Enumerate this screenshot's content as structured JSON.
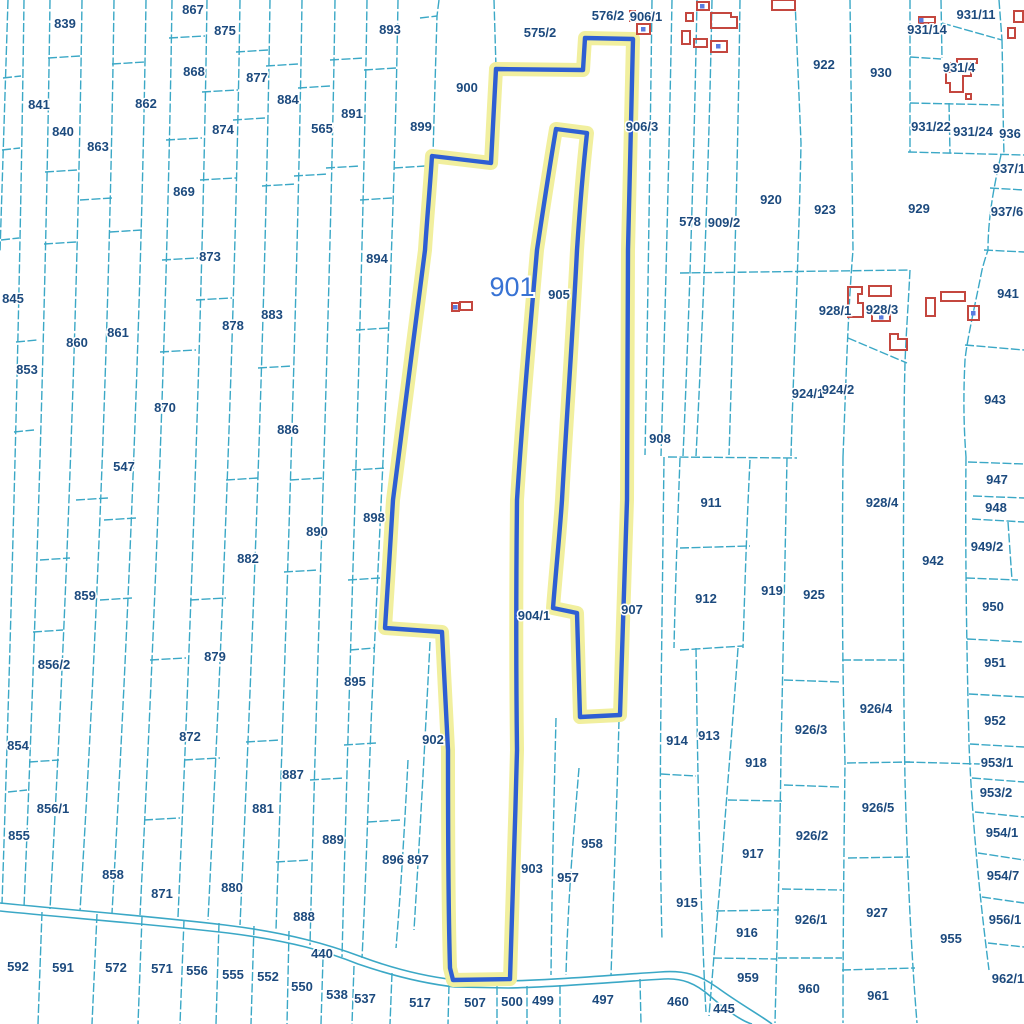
{
  "map": {
    "selected_parcel_id": "901",
    "colors": {
      "background": "#ffffff",
      "parcel_boundary": "#3ba8c6",
      "parcel_label": "#1c4a7e",
      "selected_outline": "#2e5fd3",
      "selected_halo": "#f1ef9e",
      "selected_label": "#3873d4",
      "building_outline": "#c4473f",
      "building_dot": "#5a7ce0"
    },
    "labels": [
      {
        "id": "839",
        "x": 65,
        "y": 23
      },
      {
        "id": "841",
        "x": 39,
        "y": 104
      },
      {
        "id": "840",
        "x": 63,
        "y": 131
      },
      {
        "id": "862",
        "x": 146,
        "y": 103
      },
      {
        "id": "863",
        "x": 98,
        "y": 146
      },
      {
        "id": "867",
        "x": 193,
        "y": 9
      },
      {
        "id": "875",
        "x": 225,
        "y": 30
      },
      {
        "id": "868",
        "x": 194,
        "y": 71
      },
      {
        "id": "877",
        "x": 257,
        "y": 77
      },
      {
        "id": "874",
        "x": 223,
        "y": 129
      },
      {
        "id": "884",
        "x": 288,
        "y": 99
      },
      {
        "id": "565",
        "x": 322,
        "y": 128
      },
      {
        "id": "891",
        "x": 352,
        "y": 113
      },
      {
        "id": "869",
        "x": 184,
        "y": 191
      },
      {
        "id": "893",
        "x": 390,
        "y": 29
      },
      {
        "id": "899",
        "x": 421,
        "y": 126
      },
      {
        "id": "900",
        "x": 467,
        "y": 87
      },
      {
        "id": "575/2",
        "x": 540,
        "y": 32
      },
      {
        "id": "576/2",
        "x": 608,
        "y": 15
      },
      {
        "id": "906/1",
        "x": 646,
        "y": 16
      },
      {
        "id": "906/3",
        "x": 642,
        "y": 126
      },
      {
        "id": "578",
        "x": 690,
        "y": 221
      },
      {
        "id": "909/2",
        "x": 724,
        "y": 222
      },
      {
        "id": "920",
        "x": 771,
        "y": 199
      },
      {
        "id": "922",
        "x": 824,
        "y": 64
      },
      {
        "id": "923",
        "x": 825,
        "y": 209
      },
      {
        "id": "930",
        "x": 881,
        "y": 72
      },
      {
        "id": "929",
        "x": 919,
        "y": 208
      },
      {
        "id": "931/11",
        "x": 976,
        "y": 14
      },
      {
        "id": "931/14",
        "x": 927,
        "y": 29
      },
      {
        "id": "931/4",
        "x": 959,
        "y": 67
      },
      {
        "id": "931/22",
        "x": 931,
        "y": 126
      },
      {
        "id": "931/24",
        "x": 973,
        "y": 131
      },
      {
        "id": "936",
        "x": 1010,
        "y": 133
      },
      {
        "id": "937/1",
        "x": 1009,
        "y": 168
      },
      {
        "id": "937/6",
        "x": 1007,
        "y": 211
      },
      {
        "id": "941",
        "x": 1008,
        "y": 293
      },
      {
        "id": "845",
        "x": 13,
        "y": 298
      },
      {
        "id": "853",
        "x": 27,
        "y": 369
      },
      {
        "id": "860",
        "x": 77,
        "y": 342
      },
      {
        "id": "861",
        "x": 118,
        "y": 332
      },
      {
        "id": "870",
        "x": 165,
        "y": 407
      },
      {
        "id": "873",
        "x": 210,
        "y": 256
      },
      {
        "id": "878",
        "x": 233,
        "y": 325
      },
      {
        "id": "883",
        "x": 272,
        "y": 314
      },
      {
        "id": "886",
        "x": 288,
        "y": 429
      },
      {
        "id": "894",
        "x": 377,
        "y": 258
      },
      {
        "id": "901",
        "x": 512,
        "y": 287,
        "big": true
      },
      {
        "id": "905",
        "x": 559,
        "y": 294
      },
      {
        "id": "908",
        "x": 660,
        "y": 438
      },
      {
        "id": "928/1",
        "x": 835,
        "y": 310
      },
      {
        "id": "928/3",
        "x": 882,
        "y": 309
      },
      {
        "id": "924/1",
        "x": 808,
        "y": 393
      },
      {
        "id": "924/2",
        "x": 838,
        "y": 389
      },
      {
        "id": "943",
        "x": 995,
        "y": 399
      },
      {
        "id": "947",
        "x": 997,
        "y": 479
      },
      {
        "id": "547",
        "x": 124,
        "y": 466
      },
      {
        "id": "890",
        "x": 317,
        "y": 531
      },
      {
        "id": "898",
        "x": 374,
        "y": 517
      },
      {
        "id": "882",
        "x": 248,
        "y": 558
      },
      {
        "id": "859",
        "x": 85,
        "y": 595
      },
      {
        "id": "856/2",
        "x": 54,
        "y": 664
      },
      {
        "id": "854",
        "x": 18,
        "y": 745
      },
      {
        "id": "879",
        "x": 215,
        "y": 656
      },
      {
        "id": "895",
        "x": 355,
        "y": 681
      },
      {
        "id": "872",
        "x": 190,
        "y": 736
      },
      {
        "id": "902",
        "x": 433,
        "y": 739
      },
      {
        "id": "904/1",
        "x": 534,
        "y": 615
      },
      {
        "id": "907",
        "x": 632,
        "y": 609
      },
      {
        "id": "911",
        "x": 711,
        "y": 502
      },
      {
        "id": "912",
        "x": 706,
        "y": 598
      },
      {
        "id": "919",
        "x": 772,
        "y": 590
      },
      {
        "id": "925",
        "x": 814,
        "y": 594
      },
      {
        "id": "928/4",
        "x": 882,
        "y": 502
      },
      {
        "id": "942",
        "x": 933,
        "y": 560
      },
      {
        "id": "948",
        "x": 996,
        "y": 507
      },
      {
        "id": "949/2",
        "x": 987,
        "y": 546
      },
      {
        "id": "950",
        "x": 993,
        "y": 606
      },
      {
        "id": "951",
        "x": 995,
        "y": 662
      },
      {
        "id": "926/4",
        "x": 876,
        "y": 708
      },
      {
        "id": "926/3",
        "x": 811,
        "y": 729
      },
      {
        "id": "913",
        "x": 709,
        "y": 735
      },
      {
        "id": "914",
        "x": 677,
        "y": 740
      },
      {
        "id": "952",
        "x": 995,
        "y": 720
      },
      {
        "id": "918",
        "x": 756,
        "y": 762
      },
      {
        "id": "953/1",
        "x": 997,
        "y": 762
      },
      {
        "id": "953/2",
        "x": 996,
        "y": 792
      },
      {
        "id": "917",
        "x": 753,
        "y": 853
      },
      {
        "id": "926/2",
        "x": 812,
        "y": 835
      },
      {
        "id": "926/5",
        "x": 878,
        "y": 807
      },
      {
        "id": "954/1",
        "x": 1002,
        "y": 832
      },
      {
        "id": "954/7",
        "x": 1003,
        "y": 875
      },
      {
        "id": "956/1",
        "x": 1005,
        "y": 919
      },
      {
        "id": "926/1",
        "x": 811,
        "y": 919
      },
      {
        "id": "927",
        "x": 877,
        "y": 912
      },
      {
        "id": "955",
        "x": 951,
        "y": 938
      },
      {
        "id": "916",
        "x": 747,
        "y": 932
      },
      {
        "id": "959",
        "x": 748,
        "y": 977
      },
      {
        "id": "960",
        "x": 809,
        "y": 988
      },
      {
        "id": "961",
        "x": 878,
        "y": 995
      },
      {
        "id": "962/1",
        "x": 1008,
        "y": 978
      },
      {
        "id": "915",
        "x": 687,
        "y": 902
      },
      {
        "id": "958",
        "x": 592,
        "y": 843
      },
      {
        "id": "957",
        "x": 568,
        "y": 877
      },
      {
        "id": "903",
        "x": 532,
        "y": 868
      },
      {
        "id": "896",
        "x": 393,
        "y": 859
      },
      {
        "id": "897",
        "x": 418,
        "y": 859
      },
      {
        "id": "888",
        "x": 304,
        "y": 916
      },
      {
        "id": "889",
        "x": 333,
        "y": 839
      },
      {
        "id": "887",
        "x": 293,
        "y": 774
      },
      {
        "id": "881",
        "x": 263,
        "y": 808
      },
      {
        "id": "880",
        "x": 232,
        "y": 887
      },
      {
        "id": "871",
        "x": 162,
        "y": 893
      },
      {
        "id": "858",
        "x": 113,
        "y": 874
      },
      {
        "id": "855",
        "x": 19,
        "y": 835
      },
      {
        "id": "856/1",
        "x": 53,
        "y": 808
      },
      {
        "id": "440",
        "x": 322,
        "y": 953
      },
      {
        "id": "550",
        "x": 302,
        "y": 986
      },
      {
        "id": "538",
        "x": 337,
        "y": 994
      },
      {
        "id": "537",
        "x": 365,
        "y": 998
      },
      {
        "id": "517",
        "x": 420,
        "y": 1002
      },
      {
        "id": "507",
        "x": 475,
        "y": 1002
      },
      {
        "id": "500",
        "x": 512,
        "y": 1001
      },
      {
        "id": "499",
        "x": 543,
        "y": 1000
      },
      {
        "id": "497",
        "x": 603,
        "y": 999
      },
      {
        "id": "460",
        "x": 678,
        "y": 1001
      },
      {
        "id": "445",
        "x": 724,
        "y": 1008
      },
      {
        "id": "592",
        "x": 18,
        "y": 966
      },
      {
        "id": "591",
        "x": 63,
        "y": 967
      },
      {
        "id": "572",
        "x": 116,
        "y": 967
      },
      {
        "id": "571",
        "x": 162,
        "y": 968
      },
      {
        "id": "556",
        "x": 197,
        "y": 970
      },
      {
        "id": "555",
        "x": 233,
        "y": 974
      },
      {
        "id": "552",
        "x": 268,
        "y": 976
      }
    ],
    "buildings": [
      {
        "points": "452,303 459,303 459,311 452,311",
        "dot": [
          455,
          307
        ]
      },
      {
        "points": "460,302 472,302 472,310 460,310"
      },
      {
        "points": "630,11 635,11 635,21 630,21"
      },
      {
        "points": "637,24 650,24 650,34 637,34",
        "dot": [
          643,
          29
        ]
      },
      {
        "points": "697,2 709,2 709,10 697,10",
        "dot": [
          702,
          6
        ]
      },
      {
        "points": "686,13 693,13 693,21 686,21"
      },
      {
        "points": "711,13 731,13 731,17 737,17 737,28 711,28"
      },
      {
        "points": "682,31 690,31 690,44 682,44"
      },
      {
        "points": "694,39 707,39 707,47 694,47"
      },
      {
        "points": "711,41 727,41 727,52 711,52",
        "dot": [
          718,
          46
        ]
      },
      {
        "points": "772,0 795,0 795,10 772,10"
      },
      {
        "points": "1014,11 1023,11 1023,22 1014,22"
      },
      {
        "points": "1008,28 1015,28 1015,38 1008,38"
      },
      {
        "points": "919,17 935,17 935,23 919,23",
        "dot": [
          921,
          20
        ]
      },
      {
        "points": "946,72 951,72 951,63 957,63 957,59 977,59 977,63 971,63 971,76 963,76 963,92 950,92 950,83 946,83",
        "dot": [
          967,
          67
        ]
      },
      {
        "points": "966,94 971,94 971,99 966,99"
      },
      {
        "points": "848,287 862,287 862,294 858,294 858,303 863,303 863,317 848,317"
      },
      {
        "points": "869,286 891,286 891,296 869,296"
      },
      {
        "points": "872,313 890,313 890,321 872,321",
        "dot": [
          881,
          317
        ]
      },
      {
        "points": "890,334 898,334 898,339 907,339 907,350 890,350"
      },
      {
        "points": "926,298 935,298 935,316 926,316"
      },
      {
        "points": "941,292 965,292 965,301 941,301"
      },
      {
        "points": "968,306 979,306 979,320 968,320",
        "dot": [
          973,
          313
        ]
      }
    ]
  }
}
